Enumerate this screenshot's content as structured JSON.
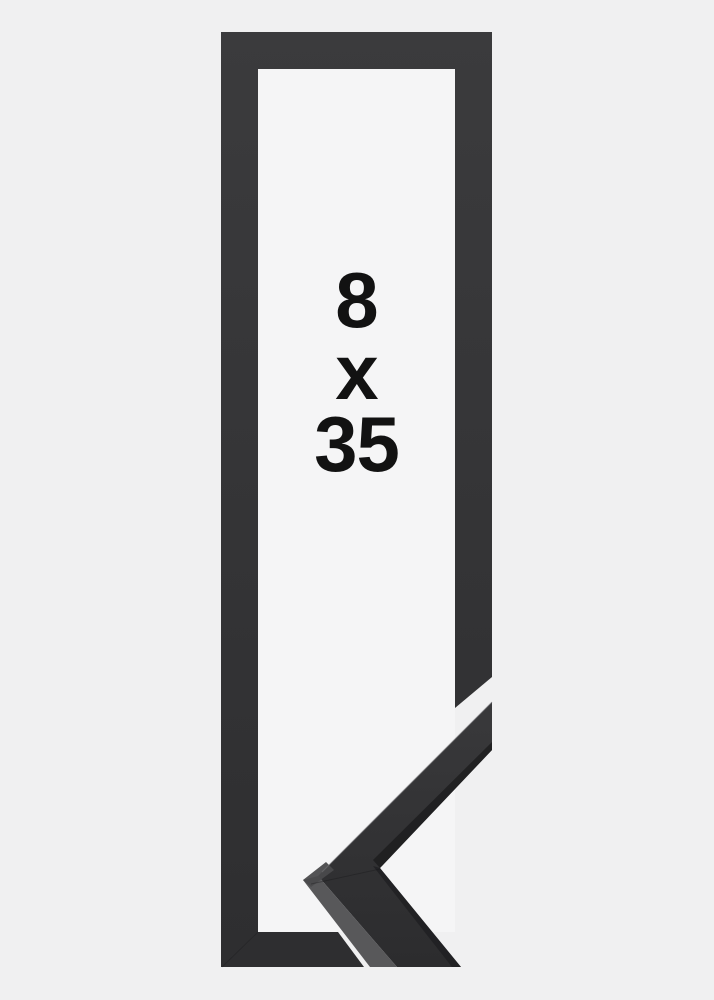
{
  "product": {
    "size_label": {
      "width": "8",
      "separator": "x",
      "height": "35",
      "display": "8 x 35"
    },
    "frame_color_name": "black"
  },
  "colors": {
    "background": "#f0f0f1",
    "inner_background": "#f5f5f6",
    "frame_top": "#3b3b3d",
    "frame_bottom": "#2e2e30",
    "chevron_face_top": "#39393b",
    "chevron_face_bottom": "#2c2c2e",
    "chevron_side": "#58585a",
    "chevron_edge_dark": "#1d1d1f",
    "text": "#121212"
  }
}
